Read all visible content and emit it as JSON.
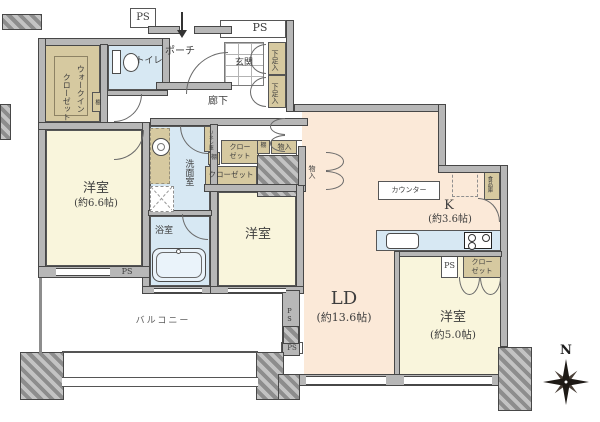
{
  "floorplan": {
    "rooms": {
      "wic": {
        "name_line1": "ウォークイン",
        "name_line2": "クローゼット"
      },
      "toilet": {
        "name": "トイレ"
      },
      "porch": {
        "name": "ポーチ"
      },
      "entrance": {
        "name": "玄関"
      },
      "corridor": {
        "name": "廊下"
      },
      "bedroom_main": {
        "name": "洋室",
        "size": "(約6.6帖)"
      },
      "washroom": {
        "name": "洗面室"
      },
      "bathroom": {
        "name": "浴室"
      },
      "bedroom_center": {
        "name": "洋室"
      },
      "living_dining": {
        "name": "LD",
        "size": "(約13.6帖)"
      },
      "kitchen": {
        "name": "K",
        "size": "(約3.6帖)"
      },
      "bedroom_small": {
        "name": "洋室",
        "size": "(約5.0帖)"
      },
      "balcony": {
        "name": "バルコニー"
      }
    },
    "storage": {
      "shoe_in_upper": "下足入",
      "shoe_in_lower": "下足入",
      "wic_shelf": "棚",
      "linen": "リネン庫",
      "shelf_hall": "棚",
      "closet_hall_upper": {
        "line1": "クロー",
        "line2": "ゼット"
      },
      "closet_hall_lower": "クローゼット",
      "shelf_small": "棚",
      "storage_hall": "物入",
      "storage_ld": "物入",
      "counter": "カウンター",
      "pantry": "食品庫",
      "closet_kitchen": {
        "line1": "クロー",
        "line2": "ゼット"
      }
    },
    "pipe_spaces": {
      "ps_top_left": "PS",
      "ps_top_right": "PS",
      "ps_bedroom_main": "PS",
      "ps_kitchen": "PS",
      "ps_wall_vertical": "PS",
      "ps_balcony": "PS"
    },
    "compass": {
      "north": "N"
    },
    "colors": {
      "wall": "#b7b7b7",
      "bedroom": "#f9f5dc",
      "living": "#fbe9d8",
      "wet_area": "#d7e8f3",
      "storage": "#d6c9a0"
    }
  }
}
